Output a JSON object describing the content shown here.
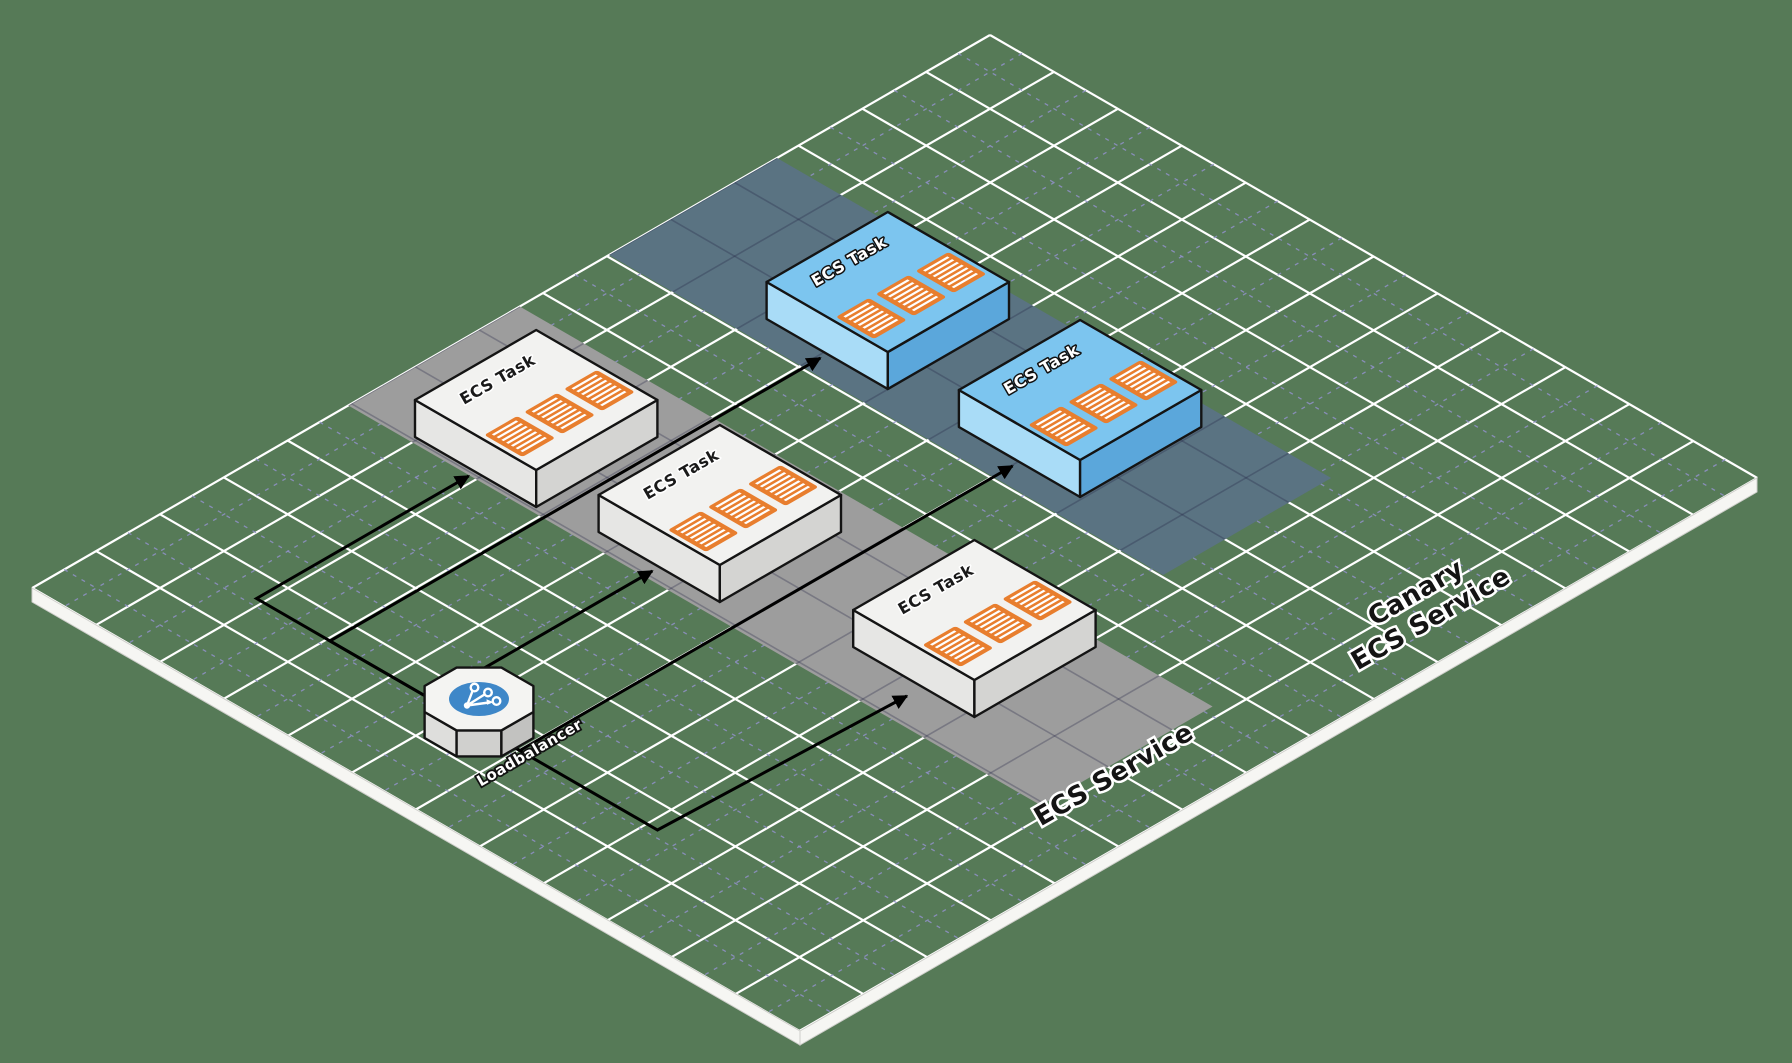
{
  "labels": {
    "task": "ECS Task",
    "loadbalancer": "Loadbalancer"
  },
  "lanes": [
    {
      "name": "ECS Service",
      "color": "#9D9D9D",
      "task_count": 3
    },
    {
      "name_line1": "Canary",
      "name_line2": "ECS Service",
      "color": "#5A7382",
      "task_count": 2
    }
  ],
  "connections": [
    {
      "from": "Loadbalancer",
      "to": "ECS Task 1",
      "lane": "ECS Service"
    },
    {
      "from": "Loadbalancer",
      "to": "ECS Task 2",
      "lane": "ECS Service"
    },
    {
      "from": "Loadbalancer",
      "to": "ECS Task 3",
      "lane": "ECS Service"
    },
    {
      "from": "Loadbalancer",
      "to": "Canary ECS Task 1",
      "lane": "Canary ECS Service"
    },
    {
      "from": "Loadbalancer",
      "to": "Canary ECS Task 2",
      "lane": "Canary ECS Service"
    }
  ],
  "colors": {
    "background": "#567A57",
    "grid_line": "#FFFFFF",
    "grid_dashed_line": "#9191C9",
    "plane_edge": "#F6F6F3",
    "lane_ecs_service": "#9D9D9D",
    "lane_canary": "#5A7382",
    "task_top": "#F2F2F0",
    "canary_task_top": "#7CC5EF",
    "container_icon": "#E87E2E",
    "loadbalancer_circle": "#3E87C8",
    "arrow": "#000000"
  }
}
